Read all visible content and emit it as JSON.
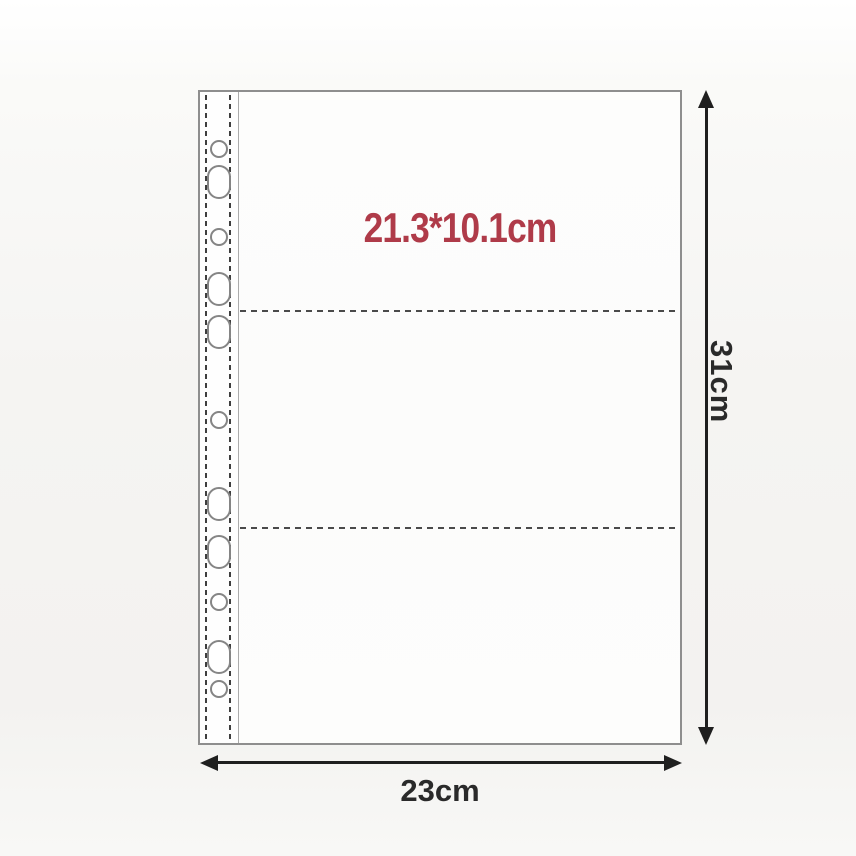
{
  "labels": {
    "pocket_size": "21.3*10.1cm",
    "sheet_height": "31cm",
    "sheet_width": "23cm"
  },
  "pouch": {
    "pocket_count": 3,
    "divider_count": 2,
    "divider_style": "dashed"
  },
  "binder_strip": {
    "hole_count": 11,
    "holes": [
      {
        "shape": "round",
        "y": 57
      },
      {
        "shape": "oval",
        "y": 90
      },
      {
        "shape": "round",
        "y": 145
      },
      {
        "shape": "oval",
        "y": 197
      },
      {
        "shape": "oval",
        "y": 240
      },
      {
        "shape": "round",
        "y": 328
      },
      {
        "shape": "oval",
        "y": 412
      },
      {
        "shape": "oval",
        "y": 460
      },
      {
        "shape": "round",
        "y": 510
      },
      {
        "shape": "oval",
        "y": 565
      },
      {
        "shape": "round",
        "y": 597
      }
    ]
  },
  "colors": {
    "accent_red": "#af3b49",
    "dimension_text": "#2a2a2a",
    "arrow": "#1f1f1f",
    "outline": "#8e8e8e",
    "dash": "#4a4a4a"
  }
}
